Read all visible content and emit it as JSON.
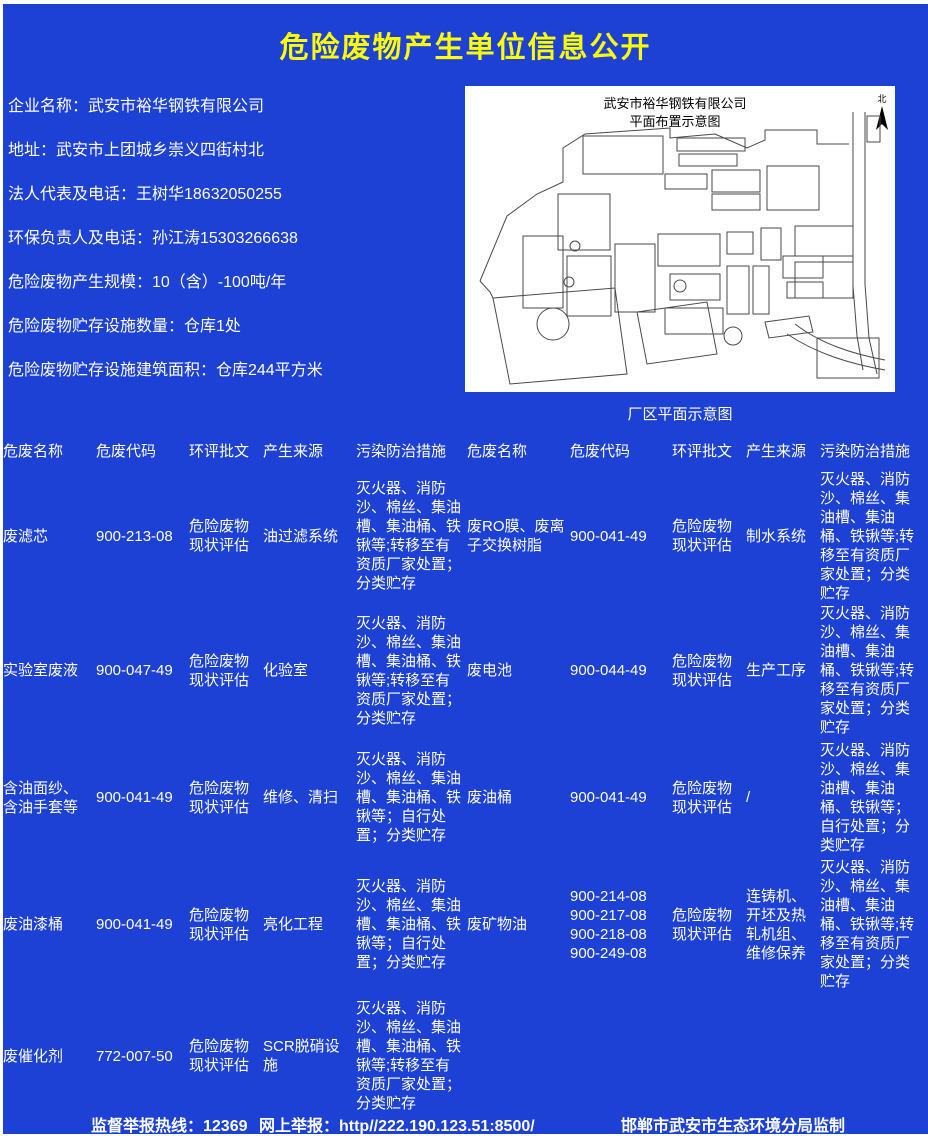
{
  "page": {
    "title": "危险废物产生单位信息公开",
    "background_color": "#1c41d4",
    "title_color": "#ffff00",
    "text_color": "#ffffff"
  },
  "info": {
    "items": [
      "企业名称：武安市裕华钢铁有限公司",
      "地址：武安市上团城乡崇义四街村北",
      "法人代表及电话：王树华18632050255",
      "环保负责人及电话：孙江涛15303266638",
      "危险废物产生规模：10（含）-100吨/年",
      "危险废物贮存设施数量：仓库1处",
      "危险废物贮存设施建筑面积：仓库244平方米"
    ]
  },
  "map": {
    "title_line1": "武安市裕华钢铁有限公司",
    "title_line2": "平面布置示意图",
    "north_label": "北",
    "caption": "厂区平面示意图"
  },
  "table": {
    "headers": [
      "危废名称",
      "危废代码",
      "环评批文",
      "产生来源",
      "污染防治措施"
    ],
    "rows_left": [
      {
        "name": "废滤芯",
        "code": "900-213-08",
        "approval": "危险废物现状评估",
        "source": "油过滤系统",
        "measures": "灭火器、消防沙、棉丝、集油槽、集油桶、铁锹等;转移至有资质厂家处置；分类贮存"
      },
      {
        "name": "实验室废液",
        "code": "900-047-49",
        "approval": "危险废物现状评估",
        "source": "化验室",
        "measures": "灭火器、消防沙、棉丝、集油槽、集油桶、铁锹等;转移至有资质厂家处置；分类贮存"
      },
      {
        "name": "含油面纱、含油手套等",
        "code": "900-041-49",
        "approval": "危险废物现状评估",
        "source": "维修、清扫",
        "measures": "灭火器、消防沙、棉丝、集油槽、集油桶、铁锹等；自行处置；分类贮存"
      },
      {
        "name": "废油漆桶",
        "code": "900-041-49",
        "approval": "危险废物现状评估",
        "source": "亮化工程",
        "measures": "灭火器、消防沙、棉丝、集油槽、集油桶、铁锹等；自行处置；分类贮存"
      },
      {
        "name": "废催化剂",
        "code": "772-007-50",
        "approval": "危险废物现状评估",
        "source": "SCR脱硝设施",
        "measures": "灭火器、消防沙、棉丝、集油槽、集油桶、铁锹等;转移至有资质厂家处置；分类贮存"
      }
    ],
    "rows_right": [
      {
        "name": "废RO膜、废离子交换树脂",
        "code": "900-041-49",
        "approval": "危险废物现状评估",
        "source": "制水系统",
        "measures": "灭火器、消防沙、棉丝、集油槽、集油桶、铁锹等;转移至有资质厂家处置；分类贮存"
      },
      {
        "name": "废电池",
        "code": "900-044-49",
        "approval": "危险废物现状评估",
        "source": "生产工序",
        "measures": "灭火器、消防沙、棉丝、集油槽、集油桶、铁锹等;转移至有资质厂家处置；分类贮存"
      },
      {
        "name": "废油桶",
        "code": "900-041-49",
        "approval": "危险废物现状评估",
        "source": "/",
        "measures": "灭火器、消防沙、棉丝、集油槽、集油桶、铁锹等；自行处置；分类贮存"
      },
      {
        "name": "废矿物油",
        "code": "900-214-08\n900-217-08\n900-218-08\n900-249-08",
        "approval": "危险废物现状评估",
        "source": "连铸机、开坯及热轧机组、维修保养",
        "measures": "灭火器、消防沙、棉丝、集油槽、集油桶、铁锹等;转移至有资质厂家处置；分类贮存"
      }
    ]
  },
  "footer": {
    "hotline": "监督举报热线：12369",
    "online": "网上举报：http//222.190.123.51:8500/",
    "producer": "邯郸市武安市生态环境分局监制"
  }
}
